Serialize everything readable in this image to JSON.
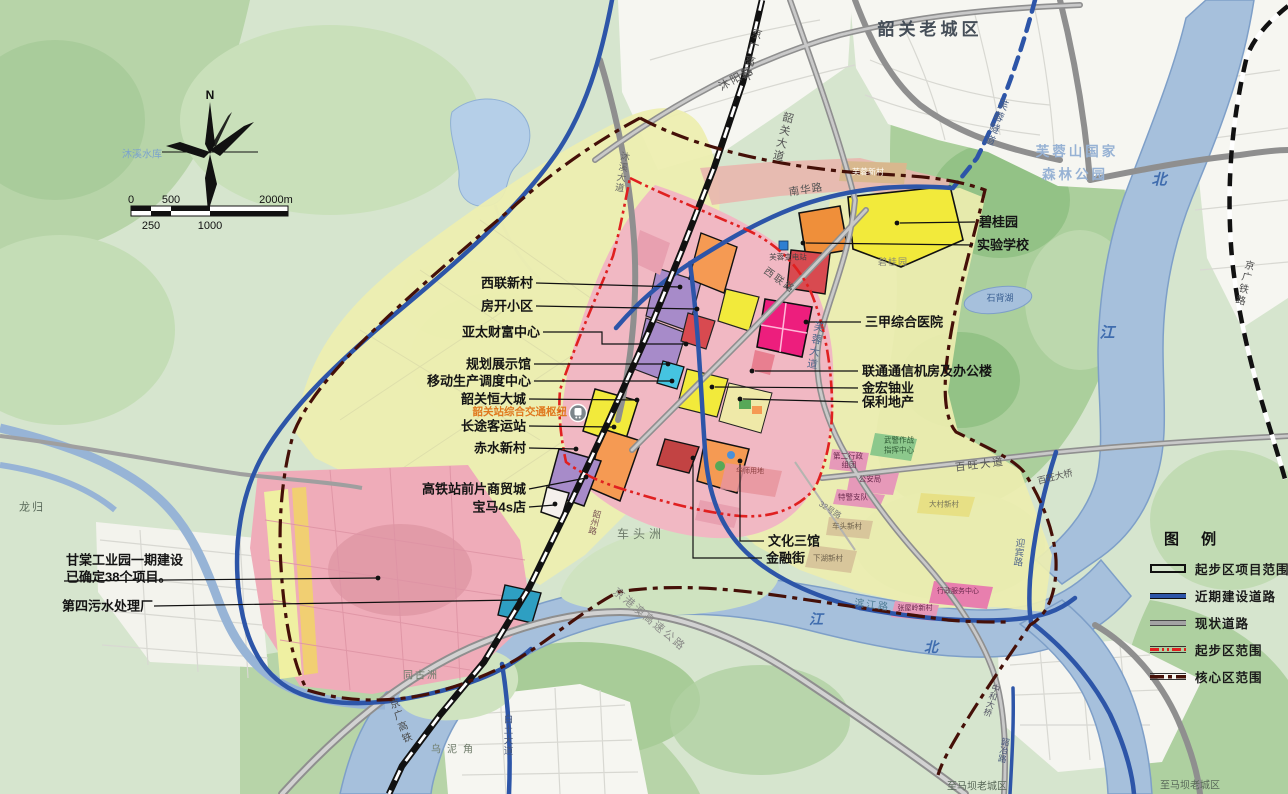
{
  "compass": {
    "north": "N"
  },
  "scalebar": {
    "s0": "0",
    "s500": "500",
    "s2000": "2000m",
    "s250": "250",
    "s1000": "1000"
  },
  "legend": {
    "title": "图 例",
    "items": [
      {
        "label": "起步区项目范围",
        "color": "#111111"
      },
      {
        "label": "近期建设道路",
        "color": "#2d55a8"
      },
      {
        "label": "现状道路",
        "color": "#a3a3a3"
      },
      {
        "label": "起步区范围",
        "color": "#e02020"
      },
      {
        "label": "核心区范围",
        "color": "#451008"
      }
    ]
  },
  "callouts": {
    "xilian_village": "西联新村",
    "fangkai": "房开小区",
    "yatai": "亚太财富中心",
    "guihua": "规划展示馆",
    "yidong": "移动生产调度中心",
    "hengda": "韶关恒大城",
    "hub": "韶关站综合交通枢纽",
    "changtu": "长途客运站",
    "chishui": "赤水新村",
    "shangmao": "高铁站前片商贸城",
    "bmw": "宝马4s店",
    "biguiyuan": "碧桂园",
    "shiyan": "实验学校",
    "hospital": "三甲综合医院",
    "liantong": "联通通信机房及办公楼",
    "jinhong": "金宏铀业",
    "baoli": "保利地产",
    "wenhua": "文化三馆",
    "jinrong": "金融街",
    "gantang_line1": "甘棠工业园一期建设",
    "gantang_line2": "已确定38个项目。",
    "sewage": "第四污水处理厂"
  },
  "map_labels": {
    "old_town": "韶关老城区",
    "muyang_road": "沐阳路",
    "jingguang_hsr_top": "京广高铁",
    "shaoguan_avenue": "韶关大道",
    "furong_tunnel": "芙蓉隧道",
    "forest_line1": "芙蓉山国家",
    "forest_line2": "森林公园",
    "bei_upper": "北",
    "jiang_upper": "江",
    "jiang_lower": "江",
    "bei_lower": "北",
    "shibei_lake": "石背湖",
    "jingguang_railway": "京广铁路",
    "nanhua_road": "南华路",
    "furong_village": "芙蓉新村",
    "furong_substation": "芙蓉变电站",
    "xilian_road": "西联路",
    "biguiyuan_area": "碧桂园",
    "furong_avenue": "芙蓉大道",
    "muxi_reservoir": "沐溪水库",
    "muxi_avenue": "沐溪大道",
    "wujing_line1": "武警作战",
    "wujing_line2": "指挥中心",
    "admin2_line1": "第二行政",
    "admin2_line2": "组团",
    "public_security": "公安局",
    "special_police": "特警支队",
    "road_32": "32号路",
    "dacun_village": "大村新村",
    "chetou_village": "车头新村",
    "xiahu_village": "下湖新村",
    "baiwang_avenue": "百旺大道",
    "baiwang_bridge": "百旺大桥",
    "yingbin_road": "迎宾路",
    "binjiang_road": "滨江路",
    "zhangwuling_village": "张屋岭新村",
    "admin_service_center": "行政服务中心",
    "chetouzhou": "车头洲",
    "jinggangao_expressway": "京港澳高速公路",
    "tongguzhou": "同古洲",
    "wunijiao": "乌泥角",
    "baitu_avenue": "白土大道",
    "jingguang_hsr_bottom": "京广高铁",
    "shaoye_road": "韶冶路",
    "zhonghe_bridge": "中和大桥",
    "to_maba_left": "至马坝老城区",
    "to_maba_right": "至马坝老城区",
    "longgui": "龙归",
    "huashi_parcel": "华师用地",
    "shaozhou_road": "韶州路"
  },
  "colors": {
    "terrain": "#d6e5ce",
    "forest": "#abcf9c",
    "water": "#a6c0dc",
    "planning_yellow": "#edeeb0",
    "industrial_pink": "#efacb9",
    "planned_road_blue": "#2d55a8",
    "existing_road_gray": "#9a9a9a",
    "railway_black": "#111111",
    "startup_boundary_red": "#e02020",
    "core_boundary_maroon": "#451008",
    "hub_text_orange": "#e07a20",
    "hospital_magenta": "#ed1e7d"
  }
}
